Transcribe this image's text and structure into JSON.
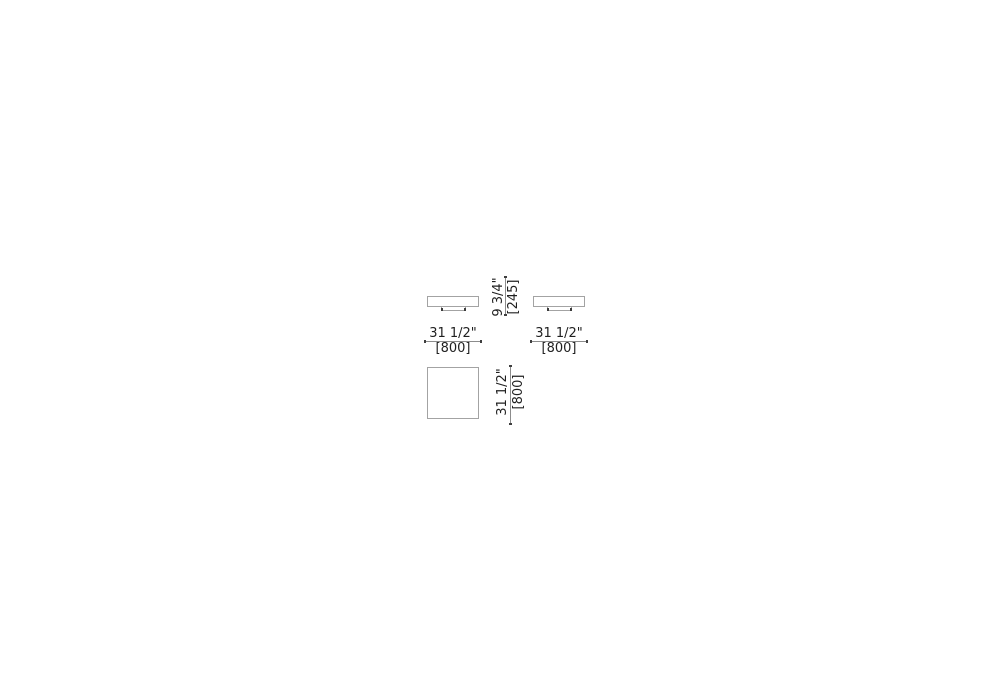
{
  "canvas": {
    "width": 1000,
    "height": 700,
    "background": "#ffffff"
  },
  "colors": {
    "shape_outline": "#a3a3a3",
    "dimension_line": "#8c8c8c",
    "dimension_tick": "#3f3f3f",
    "text": "#1f1f1f"
  },
  "dimensions": {
    "front_left_width": {
      "imperial": "31 1/2\"",
      "metric": "[800]"
    },
    "front_right_width": {
      "imperial": "31 1/2\"",
      "metric": "[800]"
    },
    "height": {
      "imperial": "9 3/4\"",
      "metric": "[245]"
    },
    "plan_depth": {
      "imperial": "31 1/2\"",
      "metric": "[800]"
    }
  }
}
